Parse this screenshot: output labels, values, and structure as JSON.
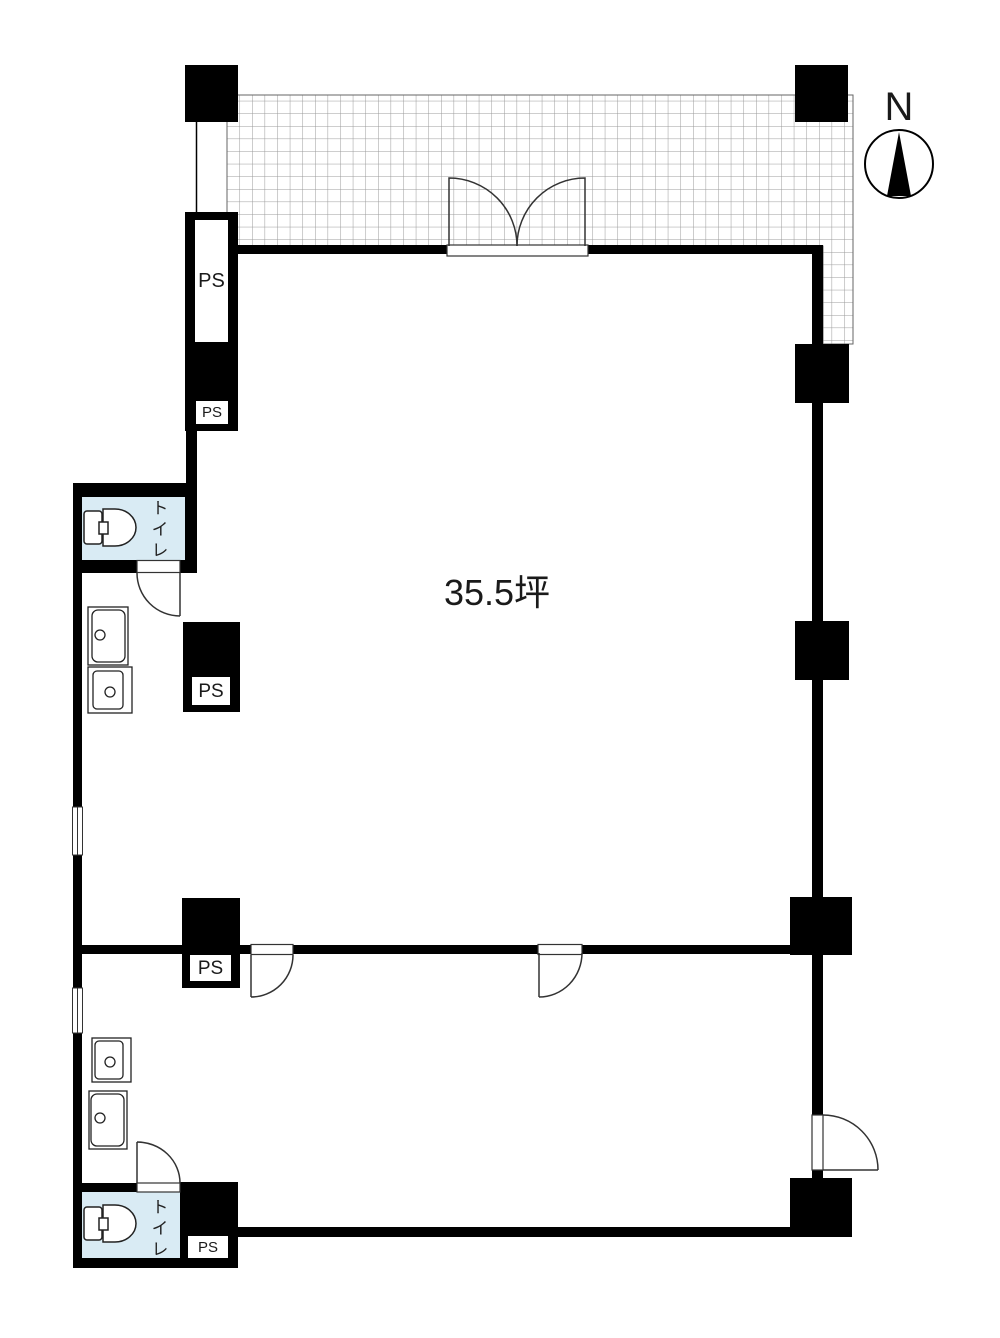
{
  "floor_plan": {
    "area_label": "35.5坪",
    "compass": {
      "label": "N",
      "direction": "north-up"
    },
    "rooms": [
      {
        "id": "main-room",
        "label": "35.5坪"
      },
      {
        "id": "toilet-upper",
        "label": "トイレ"
      },
      {
        "id": "toilet-lower",
        "label": "トイレ"
      }
    ],
    "pipe_space_labels": [
      "PS",
      "PS",
      "PS",
      "PS",
      "PS"
    ],
    "features": {
      "balcony": "hatched-grid-band-top-and-right",
      "doors": 6,
      "windows": 2,
      "sinks": 4,
      "toilets": 2
    },
    "colors": {
      "wall": "#000000",
      "toilet_room_fill": "#d9ebf4",
      "hatch_line": "#9a9a9a",
      "hatch_outline": "#666666",
      "fixture_line": "#222222",
      "door_line": "#333333"
    },
    "icons": {
      "compass": "north-compass-icon",
      "toilet": "toilet-icon",
      "sink": "sink-icon",
      "door": "door-swing-icon",
      "window": "window-icon"
    }
  }
}
